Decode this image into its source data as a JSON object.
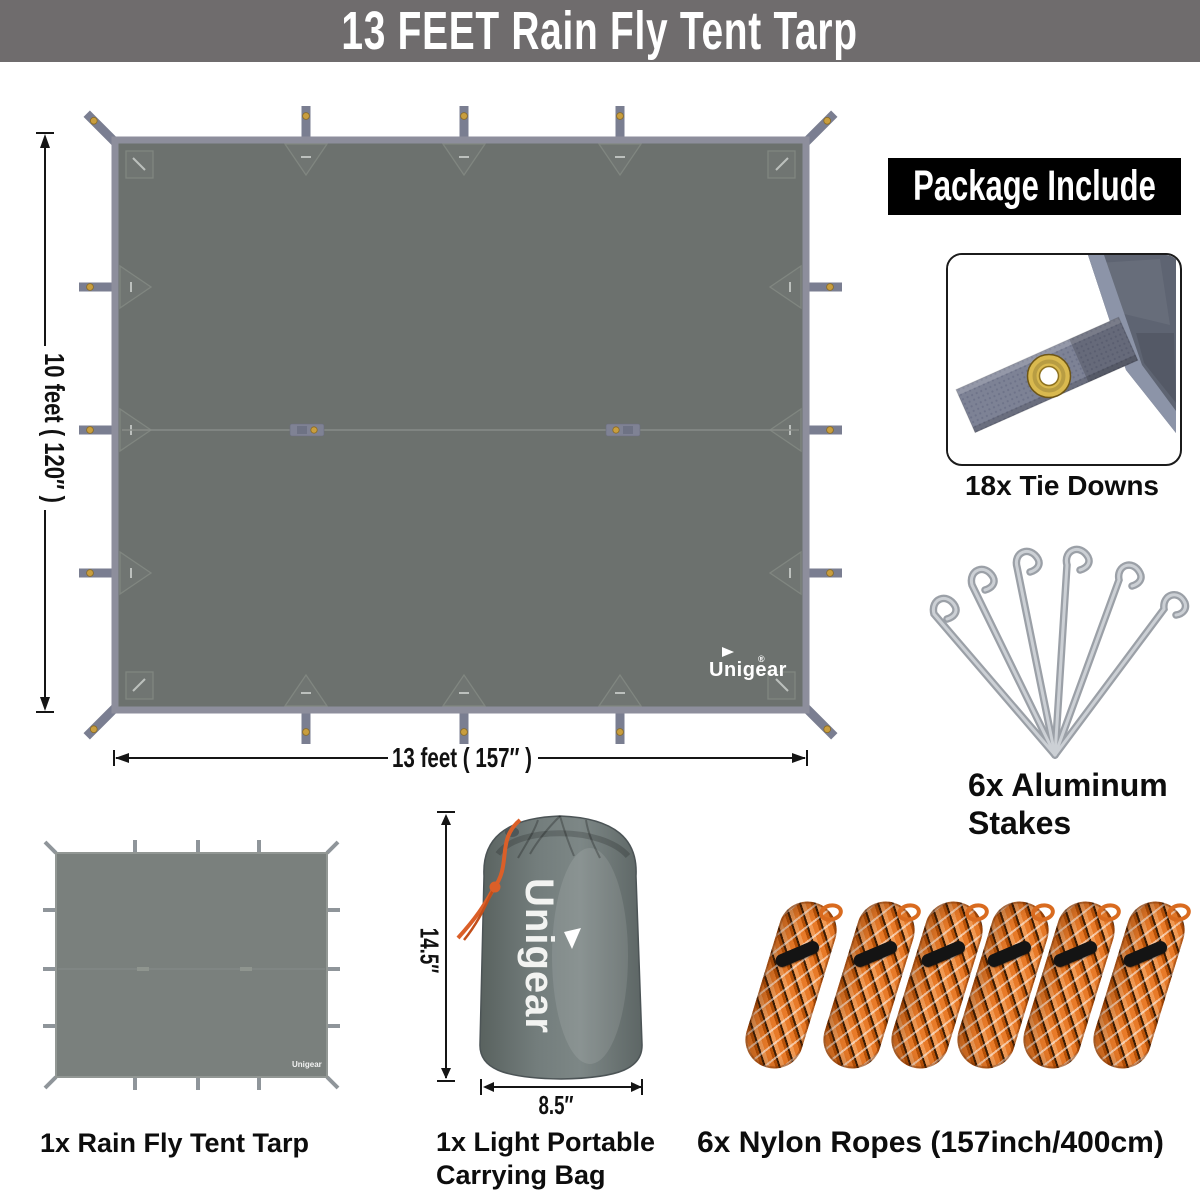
{
  "banner": {
    "title": "13 FEET  Rain Fly Tent Tarp"
  },
  "diagram": {
    "height_label": "10 feet ( 120″ )",
    "width_label": "13 feet ( 157″ )",
    "brand_logo": "Unigear",
    "brand_reg": "®"
  },
  "package": {
    "header": "Package Include",
    "tie_downs": {
      "label": "18x Tie Downs"
    },
    "stakes": {
      "label_line1": "6x Aluminum",
      "label_line2": "Stakes"
    }
  },
  "items": {
    "tarp": {
      "label": "1x Rain Fly Tent Tarp",
      "logo": "Unigear"
    },
    "bag": {
      "label_line1": "1x Light Portable",
      "label_line2": "Carrying Bag",
      "height": "14.5″",
      "width": "8.5″",
      "logo": "Unigear"
    },
    "ropes": {
      "label": "6x Nylon Ropes (157inch/400cm)"
    }
  },
  "colors": {
    "banner_bg": "#6f6c6d",
    "package_header_bg": "#000000",
    "tarp_fill": "#6c716e",
    "tarp_border": "#8d8e9c",
    "tab_gray": "#7a7e91",
    "grommet_gold": "#c99e3e",
    "rope_orange": "#e87a28",
    "bag_gray": "#6e7878",
    "stake_silver": "#a8adb3",
    "label_text": "#111111"
  }
}
